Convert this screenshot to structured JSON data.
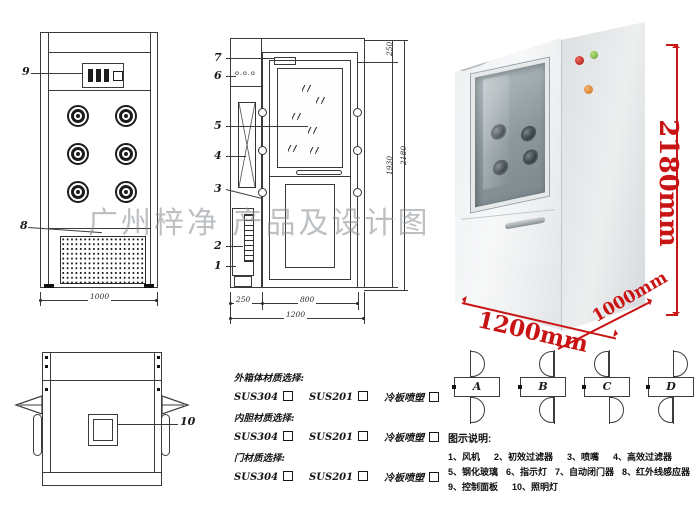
{
  "watermark": "广州梓净 产品及设计图",
  "front_view": {
    "label_control_panel": "9",
    "label_grille": "8",
    "dim_width": "1000"
  },
  "side_view": {
    "labels": {
      "door_closer": "7",
      "indicator": "6",
      "glass": "5",
      "hepa": "4",
      "nozzle": "3",
      "filter": "2",
      "fan": "1"
    },
    "indicator_dots": "o.o.o",
    "dims": {
      "left_section": "250",
      "door_width": "800",
      "total_width": "1200",
      "top_section": "250",
      "door_height": "1930",
      "total_height": "2180"
    }
  },
  "top_view": {
    "label_lamp": "10"
  },
  "photo": {
    "dims": {
      "height": "2180mm",
      "width": "1200mm",
      "depth": "1000mm"
    }
  },
  "materials": {
    "groups": [
      {
        "label": "外箱体材质选择:"
      },
      {
        "label": "内胆材质选择:"
      },
      {
        "label": "门材质选择:"
      }
    ],
    "options": [
      "SUS304",
      "SUS201",
      "冷板喷塑"
    ]
  },
  "door_icons": [
    {
      "label": "A"
    },
    {
      "label": "B"
    },
    {
      "label": "C"
    },
    {
      "label": "D"
    }
  ],
  "legend": {
    "title": "图示说明:",
    "rows": [
      [
        "1、风机",
        "2、初效过滤器",
        "3、喷嘴",
        "4、高效过滤器"
      ],
      [
        "5、钢化玻璃",
        "6、指示灯",
        "7、自动闭门器",
        "8、红外线感应器"
      ],
      [
        "9、控制面板",
        "10、照明灯"
      ]
    ]
  },
  "colors": {
    "dimension_red": "#c81414",
    "line": "#3b3b3b"
  }
}
